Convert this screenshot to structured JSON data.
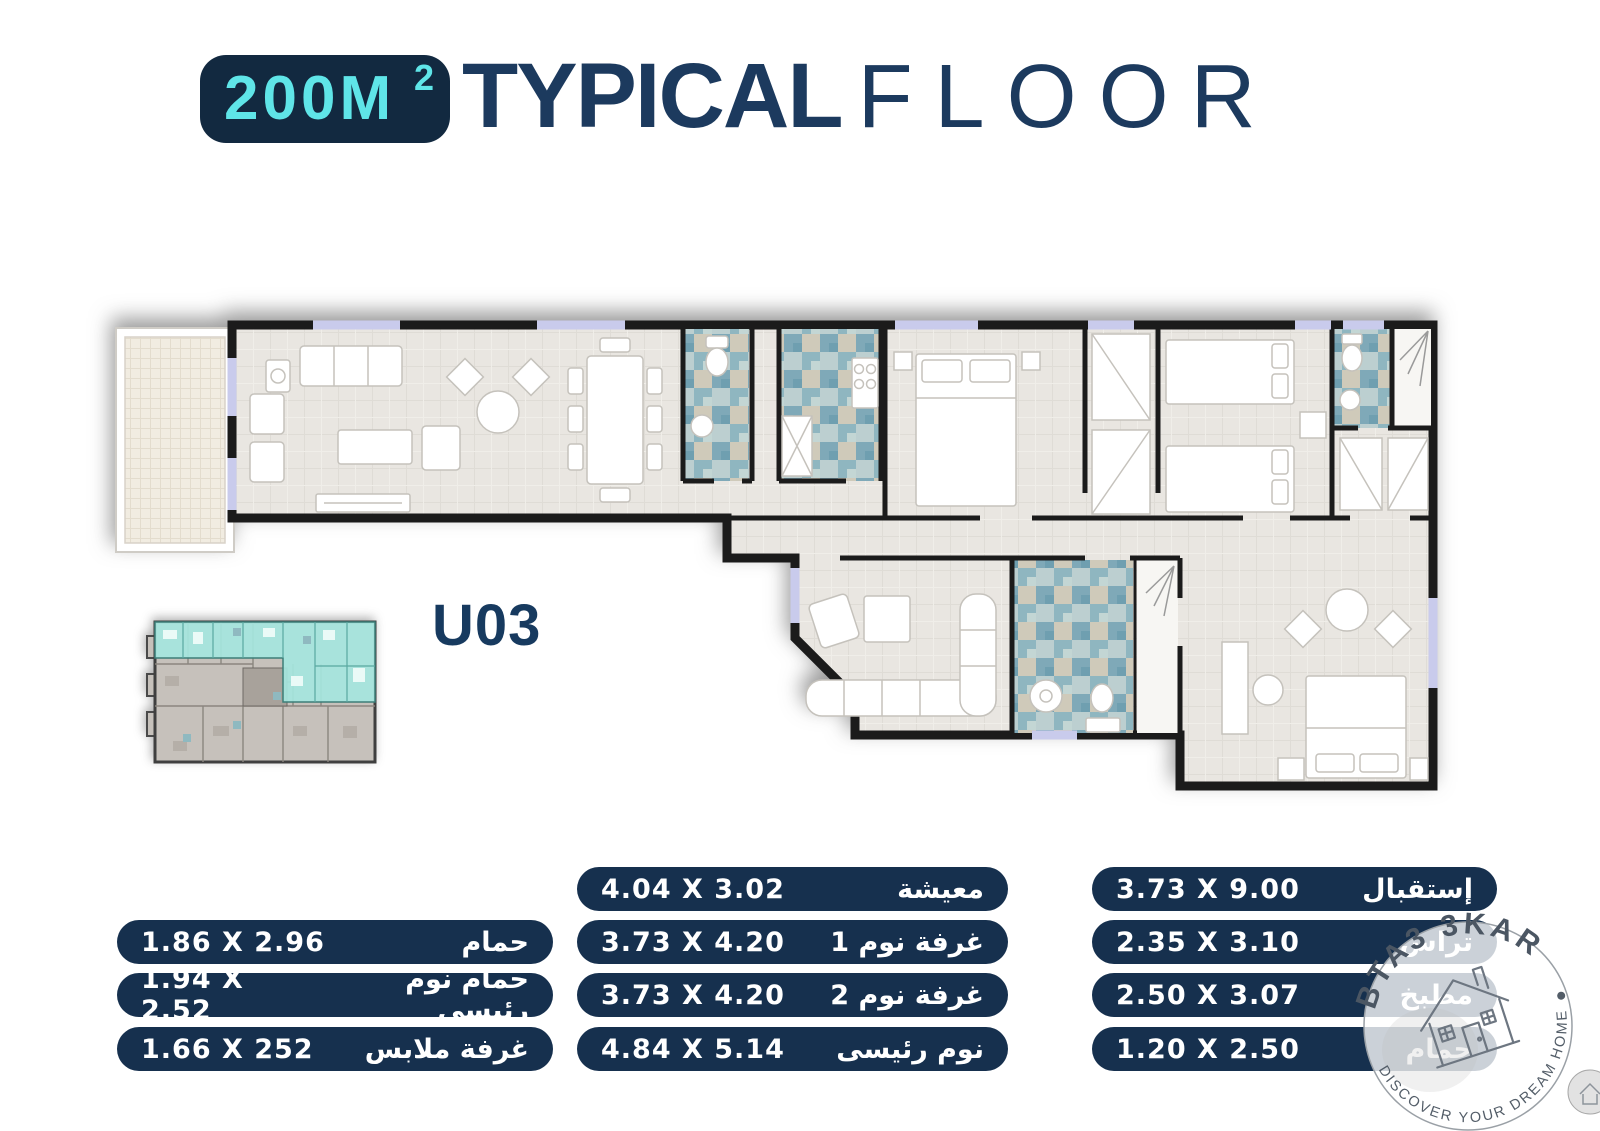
{
  "header": {
    "area_value": "200M",
    "area_superscript": "2",
    "title_primary": "TYPICAL",
    "title_secondary": "FLOOR"
  },
  "unit_label": "U03",
  "colors": {
    "badge_bg": "#122940",
    "accent_cyan": "#5fe5e8",
    "navy_text": "#1c3a5e",
    "pill_bg": "#16304e",
    "tile_teal": "#8fb6c0",
    "unit_highlight_teal": "#a5e6de",
    "window_lavender": "#c9cbec"
  },
  "tables": {
    "right": [
      {
        "name": "إستقبال",
        "dims": "3.73 X 9.00"
      },
      {
        "name": "تراس",
        "dims": "2.35 X 3.10"
      },
      {
        "name": "مطبخ",
        "dims": "2.50 X 3.07"
      },
      {
        "name": "حمام",
        "dims": "1.20 X 2.50"
      }
    ],
    "middle": [
      {
        "name": "معيشة",
        "dims": "4.04 X 3.02"
      },
      {
        "name": "غرفة نوم 1",
        "dims": "3.73 X 4.20"
      },
      {
        "name": "غرفة نوم 2",
        "dims": "3.73 X 4.20"
      },
      {
        "name": "نوم رئيسى",
        "dims": "4.84 X 5.14"
      }
    ],
    "left": [
      {
        "name": "حمام",
        "dims": "1.86 X 2.96"
      },
      {
        "name": "حمام نوم رئيسى",
        "dims": "1.94 X 2.52"
      },
      {
        "name": "غرفة ملابس",
        "dims": "1.66 X 252"
      }
    ]
  },
  "watermark": {
    "brand": "BTA3 3KAR",
    "tagline": "DISCOVER YOUR DREAM HOME",
    "icon": "house-sketch-icon"
  }
}
